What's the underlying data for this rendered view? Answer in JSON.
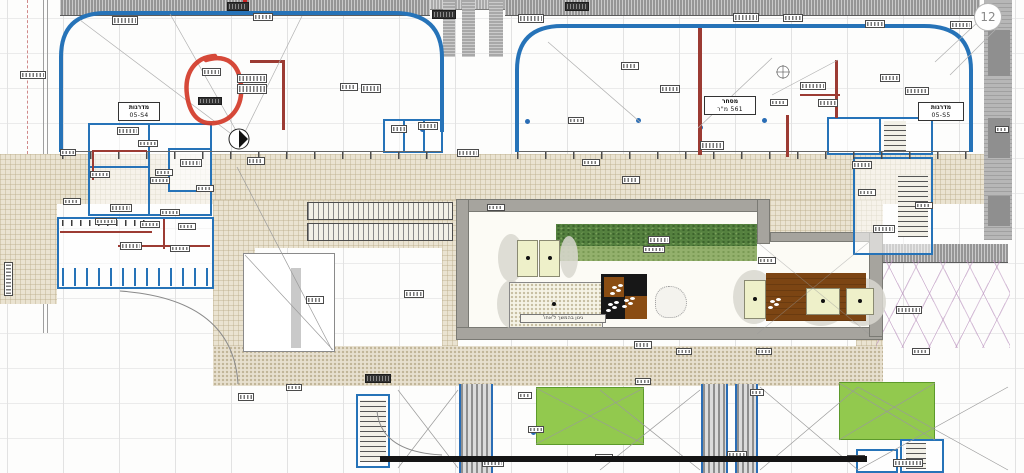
{
  "plan": {
    "labels": {
      "stairs_left": {
        "title": "מדרגות",
        "code": "05-S4"
      },
      "stairs_right": {
        "title": "מדרגות",
        "code": "05-S5"
      },
      "retail_area": {
        "title": "מסחר",
        "area": "561 מ\"ר"
      },
      "courtyard_caption": "גינון בהמשך ל'אחו'",
      "grid_bubble_top_right": "12"
    },
    "colors": {
      "wall_blue": "#2673b8",
      "annotation_red": "#d33a28",
      "plaza_beige": "#eae3d1",
      "hedge_green": "#55813f",
      "lawn_green": "#92c94e",
      "deck_brown": "#7c4513",
      "deck_black": "#171717",
      "frame_gray": "#a6a49e",
      "facade_band_gray": "#969696",
      "partition_maroon": "#9c3b33",
      "crane_zone_pink": "#d3b9d6"
    },
    "decor": {
      "micro_labels": [
        [
          112,
          16,
          26,
          9,
          0
        ],
        [
          227,
          2,
          22,
          9,
          1
        ],
        [
          253,
          13,
          20,
          8,
          0
        ],
        [
          432,
          10,
          24,
          9,
          1
        ],
        [
          518,
          14,
          26,
          9,
          0
        ],
        [
          565,
          2,
          24,
          9,
          1
        ],
        [
          733,
          13,
          26,
          9,
          0
        ],
        [
          783,
          14,
          20,
          8,
          0
        ],
        [
          865,
          20,
          20,
          8,
          0
        ],
        [
          950,
          21,
          22,
          8,
          0
        ],
        [
          202,
          68,
          19,
          8,
          0
        ],
        [
          198,
          97,
          24,
          8,
          1
        ],
        [
          237,
          74,
          30,
          9,
          0
        ],
        [
          237,
          84,
          30,
          10,
          0
        ],
        [
          340,
          83,
          18,
          8,
          0
        ],
        [
          361,
          84,
          20,
          9,
          0
        ],
        [
          418,
          122,
          20,
          8,
          0
        ],
        [
          391,
          125,
          16,
          8,
          0
        ],
        [
          117,
          127,
          22,
          8,
          0
        ],
        [
          138,
          140,
          20,
          7,
          0
        ],
        [
          60,
          149,
          16,
          7,
          0
        ],
        [
          180,
          159,
          22,
          8,
          0
        ],
        [
          90,
          171,
          20,
          7,
          0
        ],
        [
          150,
          177,
          20,
          7,
          0
        ],
        [
          196,
          185,
          18,
          7,
          0
        ],
        [
          63,
          198,
          18,
          7,
          0
        ],
        [
          110,
          204,
          22,
          8,
          0
        ],
        [
          160,
          209,
          20,
          7,
          0
        ],
        [
          95,
          218,
          22,
          7,
          0
        ],
        [
          140,
          221,
          20,
          7,
          0
        ],
        [
          178,
          223,
          18,
          7,
          0
        ],
        [
          120,
          242,
          22,
          8,
          0
        ],
        [
          170,
          245,
          20,
          7,
          0
        ],
        [
          247,
          157,
          18,
          8,
          0
        ],
        [
          457,
          149,
          22,
          8,
          0
        ],
        [
          622,
          176,
          18,
          8,
          0
        ],
        [
          852,
          161,
          20,
          8,
          0
        ],
        [
          858,
          189,
          18,
          7,
          0
        ],
        [
          155,
          169,
          18,
          7,
          0
        ],
        [
          582,
          159,
          18,
          7,
          0
        ],
        [
          700,
          141,
          24,
          9,
          0
        ],
        [
          660,
          85,
          20,
          8,
          0
        ],
        [
          621,
          62,
          18,
          8,
          0
        ],
        [
          568,
          117,
          16,
          7,
          0
        ],
        [
          800,
          82,
          26,
          8,
          0
        ],
        [
          880,
          74,
          20,
          8,
          0
        ],
        [
          905,
          87,
          24,
          8,
          0
        ],
        [
          818,
          99,
          20,
          8,
          0
        ],
        [
          770,
          99,
          18,
          7,
          0
        ],
        [
          306,
          296,
          18,
          8,
          0
        ],
        [
          404,
          290,
          20,
          8,
          0
        ],
        [
          487,
          204,
          18,
          7,
          0
        ],
        [
          648,
          236,
          22,
          8,
          0
        ],
        [
          643,
          246,
          22,
          7,
          0
        ],
        [
          758,
          257,
          18,
          7,
          0
        ],
        [
          915,
          202,
          18,
          7,
          0
        ],
        [
          873,
          225,
          22,
          8,
          0
        ],
        [
          896,
          306,
          26,
          8,
          0
        ],
        [
          634,
          341,
          18,
          8,
          0
        ],
        [
          756,
          348,
          16,
          7,
          0
        ],
        [
          912,
          348,
          18,
          7,
          0
        ],
        [
          365,
          374,
          26,
          9,
          1
        ],
        [
          286,
          384,
          16,
          7,
          0
        ],
        [
          238,
          393,
          16,
          8,
          0
        ],
        [
          635,
          378,
          16,
          7,
          0
        ],
        [
          676,
          348,
          16,
          7,
          0
        ],
        [
          727,
          451,
          20,
          8,
          0
        ],
        [
          893,
          459,
          30,
          8,
          0
        ],
        [
          482,
          459,
          22,
          8,
          0
        ],
        [
          595,
          454,
          18,
          7,
          0
        ],
        [
          847,
          455,
          18,
          7,
          0
        ],
        [
          518,
          392,
          14,
          7,
          0
        ],
        [
          528,
          426,
          16,
          7,
          0
        ],
        [
          750,
          389,
          14,
          7,
          0
        ],
        [
          20,
          71,
          26,
          8,
          0
        ],
        [
          995,
          126,
          14,
          7,
          0
        ],
        [
          4,
          262,
          9,
          34,
          2
        ]
      ],
      "junction_dots": [
        [
          573,
          118
        ],
        [
          636,
          118
        ],
        [
          698,
          125
        ],
        [
          525,
          119
        ],
        [
          762,
          118
        ],
        [
          531,
          430
        ],
        [
          420,
          127
        ]
      ]
    }
  }
}
